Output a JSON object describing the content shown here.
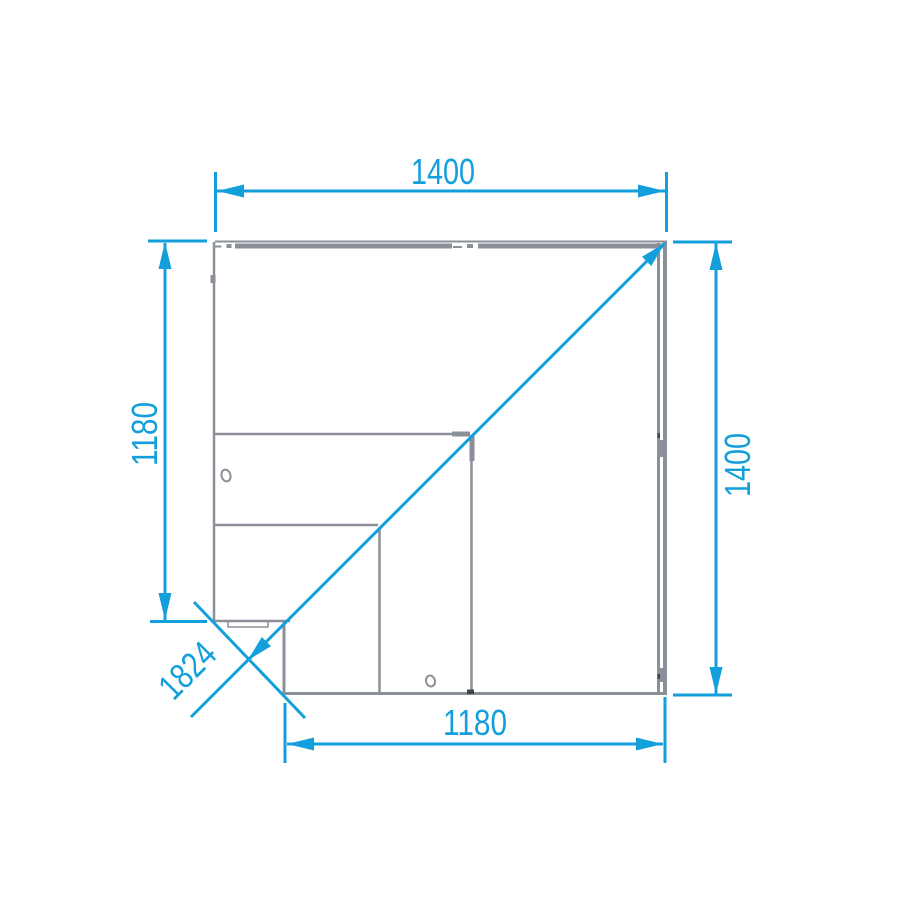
{
  "colors": {
    "accent": "#129fdb",
    "line": "#8a8f99",
    "joint": "#41464f",
    "background": "#ffffff"
  },
  "dimensions": {
    "top": "1400",
    "left": "1180",
    "right": "1400",
    "bottom": "1180",
    "diagonal": "1824"
  }
}
